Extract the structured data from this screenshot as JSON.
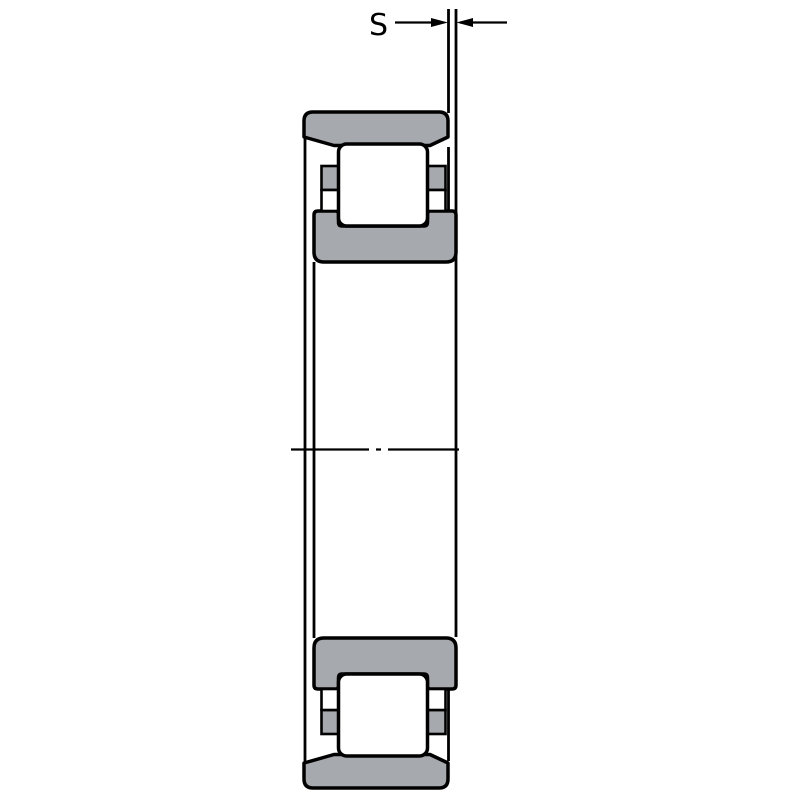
{
  "diagram": {
    "type": "bearing-cross-section-drawing",
    "dimension": {
      "label": "S"
    },
    "colors": {
      "background": "#ffffff",
      "ring_fill": "#a6a9ad",
      "outline": "#000000"
    }
  }
}
